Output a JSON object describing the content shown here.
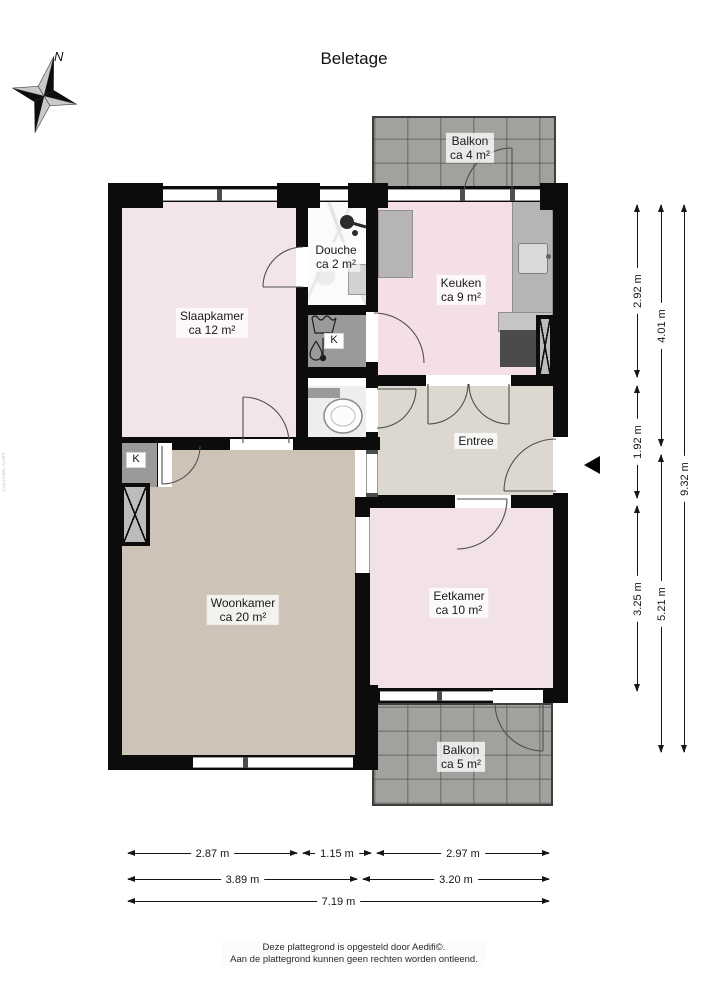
{
  "title": "Beletage",
  "compass": {
    "north": "N"
  },
  "rooms": {
    "balkon_top": {
      "name": "Balkon",
      "area": "ca 4 m²"
    },
    "slaapkamer": {
      "name": "Slaapkamer",
      "area": "ca 12 m²"
    },
    "douche": {
      "name": "Douche",
      "area": "ca 2 m²"
    },
    "keuken": {
      "name": "Keuken",
      "area": "ca 9 m²"
    },
    "entree": {
      "name": "Entree"
    },
    "woonkamer": {
      "name": "Woonkamer",
      "area": "ca 20 m²"
    },
    "eetkamer": {
      "name": "Eetkamer",
      "area": "ca 10 m²"
    },
    "balkon_bottom": {
      "name": "Balkon",
      "area": "ca 5 m²"
    }
  },
  "closets": {
    "laundry": "K",
    "living": "K"
  },
  "dimensions": {
    "right_col1": [
      "2.92 m",
      "1.92 m",
      "3.25 m"
    ],
    "right_col2": [
      "4.01 m",
      "5.21 m"
    ],
    "right_col3": [
      "9.32 m"
    ],
    "bottom_row1": [
      "2.87 m",
      "1.15 m",
      "2.97 m"
    ],
    "bottom_row2": [
      "3.89 m",
      "3.20 m"
    ],
    "bottom_row3": [
      "7.19 m"
    ]
  },
  "footer": {
    "line1": "Deze plattegrond is opgesteld door Aedifi©.",
    "line2": "Aan de plattegrond kunnen geen rechten worden ontleend."
  },
  "watermark": "Copyright Aedifi",
  "colors": {
    "wall": "#0c0c0c",
    "room_pink": "#f3e2e7",
    "room_tan": "#cec3b7",
    "room_greige": "#dcd8d0",
    "closet_gray": "#9b9a99",
    "counter_gray": "#b6b5b3",
    "appliance_dark": "#4b4b4b",
    "balcony_tile": "#a2a19e"
  }
}
